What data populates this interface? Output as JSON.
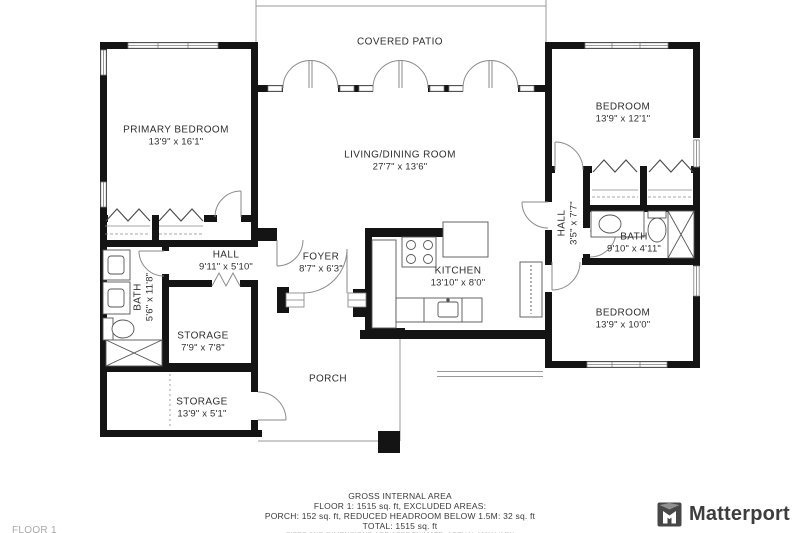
{
  "rooms": {
    "covered_patio": {
      "name": "COVERED PATIO",
      "dims": ""
    },
    "primary_bedroom": {
      "name": "PRIMARY BEDROOM",
      "dims": "13'9\" x 16'1\""
    },
    "living_dining": {
      "name": "LIVING/DINING ROOM",
      "dims": "27'7\" x 13'6\""
    },
    "bedroom_top_right": {
      "name": "BEDROOM",
      "dims": "13'9\" x 12'1\""
    },
    "hall_left": {
      "name": "HALL",
      "dims": "9'11\" x 5'10\""
    },
    "foyer": {
      "name": "FOYER",
      "dims": "8'7\" x 6'3\""
    },
    "kitchen": {
      "name": "KITCHEN",
      "dims": "13'10\" x 8'0\""
    },
    "hall_right": {
      "name": "HALL",
      "dims": "3'5\" x 7'7\""
    },
    "bath_right": {
      "name": "BATH",
      "dims": "9'10\" x 4'11\""
    },
    "bath_left": {
      "name": "BATH",
      "dims": "5'6\" x 11'8\""
    },
    "storage_inner": {
      "name": "STORAGE",
      "dims": "7'9\" x 7'8\""
    },
    "storage_bottom": {
      "name": "STORAGE",
      "dims": "13'9\" x 5'1\""
    },
    "bedroom_bottom_right": {
      "name": "BEDROOM",
      "dims": "13'9\" x 10'0\""
    },
    "porch": {
      "name": "PORCH",
      "dims": ""
    }
  },
  "footer": {
    "line1": "GROSS INTERNAL AREA",
    "line2": "FLOOR 1: 1515 sq. ft, EXCLUDED AREAS:",
    "line3": "PORCH: 152 sq. ft, REDUCED HEADROOM BELOW 1.5M: 32 sq. ft",
    "line4": "TOTAL: 1515 sq. ft",
    "line5": "SIZES AND DIMENSIONS ARE APPROXIMATE. ACTUAL MAY VARY"
  },
  "floor_label": "FLOOR 1",
  "branding": {
    "logo_text": "Matterport"
  },
  "colors": {
    "wall": "#141414",
    "text": "#2e2e2e",
    "muted": "#a8a8a8",
    "logo": "#3d3d3d"
  }
}
